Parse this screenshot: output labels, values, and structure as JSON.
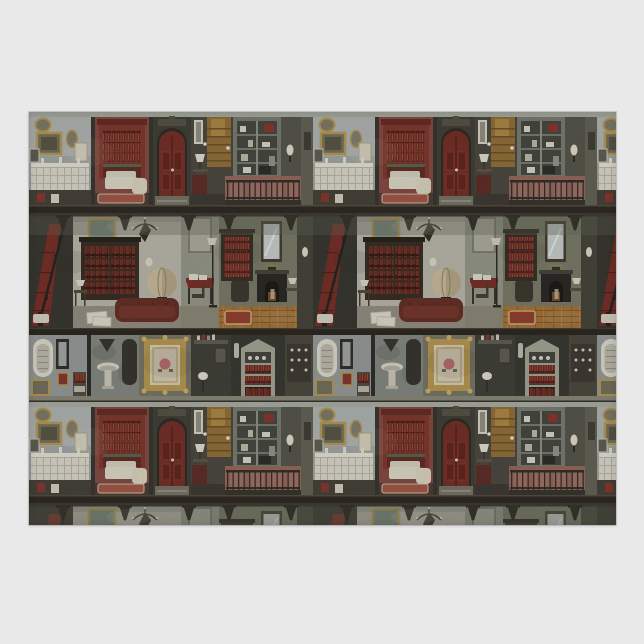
{
  "meta": {
    "alt_text": "Sheet of wrapping paper with a repeating Victorian dollhouse interior pattern: miniature antique rooms with red bookcases, a dark red arched door, gilt picture frames, a staircase with red runner, a grand library with chandelier, globe and leather chesterfield, a study with tall mirror and black fireplace on a plank floor, washstand and china-cabinet rooms, painted in muted watercolor tones on a pale grey studio background.",
    "visible_text": []
  },
  "page": {
    "background": "#e8e9e8"
  },
  "product": {
    "name": "victorian-dollhouse-pattern-sheet",
    "pattern_repeat": {
      "columns_visible": "about 2.1",
      "rows_visible": "about 1.4"
    },
    "rooms": {
      "band1": [
        "parlor with gilt picture frames and white wainscot bench",
        "red library nook with tall red bookcase and cream settee",
        "dark red arched double entry door",
        "stair hall with table lamp and glowing wooden staircase",
        "glass china cabinet above an iron balcony railing"
      ],
      "band2": [
        "staircase with dark red carpet runner",
        "grand library with chandelier, parchment globe and oxblood chesterfield sofa",
        "writing desk nook with papers and brass floor lamp",
        "study with tall mirror, black fireplace and orange plank floor with red rug"
      ],
      "band3": [
        "washroom with white arched sampler frame and pedestal basin",
        "ornate gilt frame with pink rose",
        "apothecary shelves and gothic china cabinet"
      ]
    }
  },
  "palette": {
    "divider_dark": "#39362e",
    "ceiling": "#a3a69d",
    "wall_blue_gray": "#a9aeae",
    "wall_red": "#7c4038",
    "door_red": "#6b231b",
    "surround_charcoal": "#35342d",
    "hall_wall": "#403e36",
    "stair_glow": "#8a672e",
    "cabinet_frame": "#70746a",
    "railing_wall": "#8f5e53",
    "iron_dark": "#26231d",
    "beam_dark": "#231d16",
    "valance": "#5a5d50",
    "corbel": "#2b271f",
    "stair_room": "#2d2a24",
    "runner_red": "#6e231c",
    "plaster_wall": "#b3b1a4",
    "bookcase_dark": "#2a211a",
    "book_red": "#7e2a22",
    "globe_parchment": "#c3b495",
    "sofa_oxblood": "#5c241b",
    "paper_white": "#d9d6c8",
    "library_floor": "#8b867a",
    "study_wall": "#70725f",
    "mirror_glass": "#c2c9c6",
    "fireplace_black": "#1e1d1a",
    "ember_glow": "#6e4018",
    "wood_floor": "#9c6a30",
    "rug_red": "#8a3424",
    "rug_border": "#c9a96a",
    "gilt": "#b09148",
    "cream": "#d6d3c6",
    "settee_cream": "#d8d4c4",
    "washroom_wall": "#8e9392",
    "basin_room_wall": "#7c807a",
    "rose_pink": "#bb6670",
    "china_cabinet": "#9c9c8e"
  }
}
